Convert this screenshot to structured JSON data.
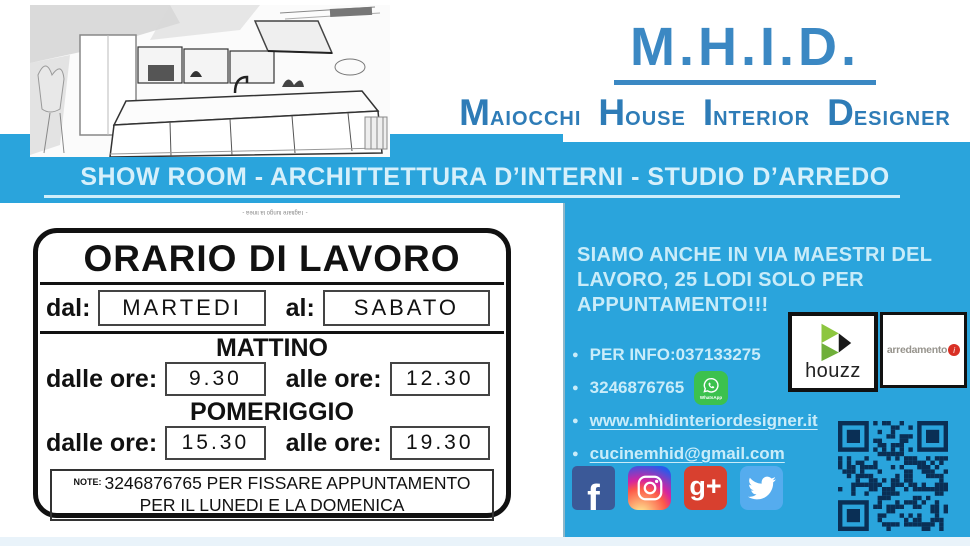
{
  "logo": {
    "title": "M.H.I.D.",
    "words": [
      {
        "initial": "M",
        "rest": "AIOCCHI"
      },
      {
        "initial": "H",
        "rest": "OUSE"
      },
      {
        "initial": "I",
        "rest": "NTERIOR"
      },
      {
        "initial": "D",
        "rest": "ESIGNER"
      }
    ]
  },
  "banner": {
    "text": "SHOW ROOM - ARCHITTETTURA D’INTERNI -  STUDIO D’ARREDO"
  },
  "sign": {
    "cut_note": "- Tagliare lungo la linea -",
    "title": "ORARIO DI LAVORO",
    "from_label": "dal:",
    "from_value": "MARTEDI",
    "to_label": "al:",
    "to_value": "SABATO",
    "morning_label": "MATTINO",
    "afternoon_label": "POMERIGGIO",
    "dalle_label": "dalle ore:",
    "alle_label": "alle ore:",
    "morning_from": "9.30",
    "morning_to": "12.30",
    "afternoon_from": "15.30",
    "afternoon_to": "19.30",
    "note_label": "NOTE:",
    "note_text": "3246876765 PER FISSARE APPUNTAMENTO PER IL LUNEDI E LA DOMENICA"
  },
  "info": {
    "lines": [
      "SIAMO ANCHE IN VIA MAESTRI DEL",
      "LAVORO, 25 LODI SOLO PER",
      "APPUNTAMENTO!!!"
    ],
    "items": [
      {
        "label": "PER INFO:037133275"
      },
      {
        "label": "3246876765"
      },
      {
        "label": "www.mhidinteriordesigner.it"
      },
      {
        "label": "cucinemhid@gmail.com"
      }
    ],
    "whatsapp_label": "WhatsApp"
  },
  "partners": {
    "houzz_label": "houzz",
    "arredamento_label": "arredamento",
    "arredamento_dot": "i"
  },
  "social": {
    "facebook_glyph": "f",
    "gplus_glyph": "g+"
  },
  "colors": {
    "background_blue": "#2aa4dc",
    "logo_blue": "#3b88c3",
    "pale_text": "#c9ecf9",
    "whatsapp_green": "#3cc14e",
    "facebook_blue": "#3b5998",
    "googleplus_red": "#d8402f",
    "twitter_blue": "#55acee",
    "houzz_green": "#7cb342",
    "arredamento_red": "#d93025",
    "qr_navy": "#0a2f55",
    "sign_ink": "#111111"
  }
}
